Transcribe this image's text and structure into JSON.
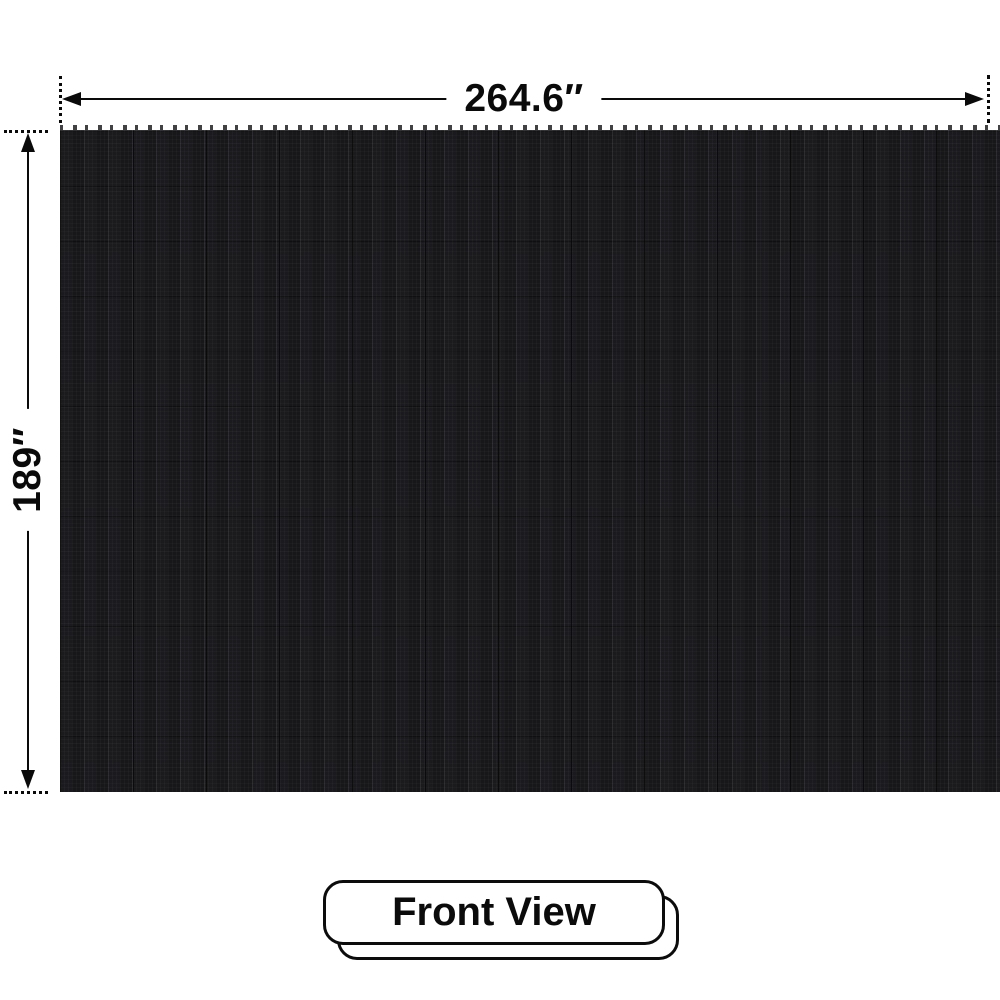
{
  "diagram": {
    "width_dimension_label": "264.6″",
    "height_dimension_label": "189″",
    "panel": {
      "description": "LED video wall panel, front view",
      "base_color": "#17171a"
    }
  },
  "badge": {
    "label": "Front View"
  },
  "colors": {
    "background": "#ffffff",
    "dimension_line": "#0a0a0a",
    "label_text": "#0a0a0a",
    "badge_border": "#0c0c0c",
    "badge_background": "#ffffff"
  }
}
